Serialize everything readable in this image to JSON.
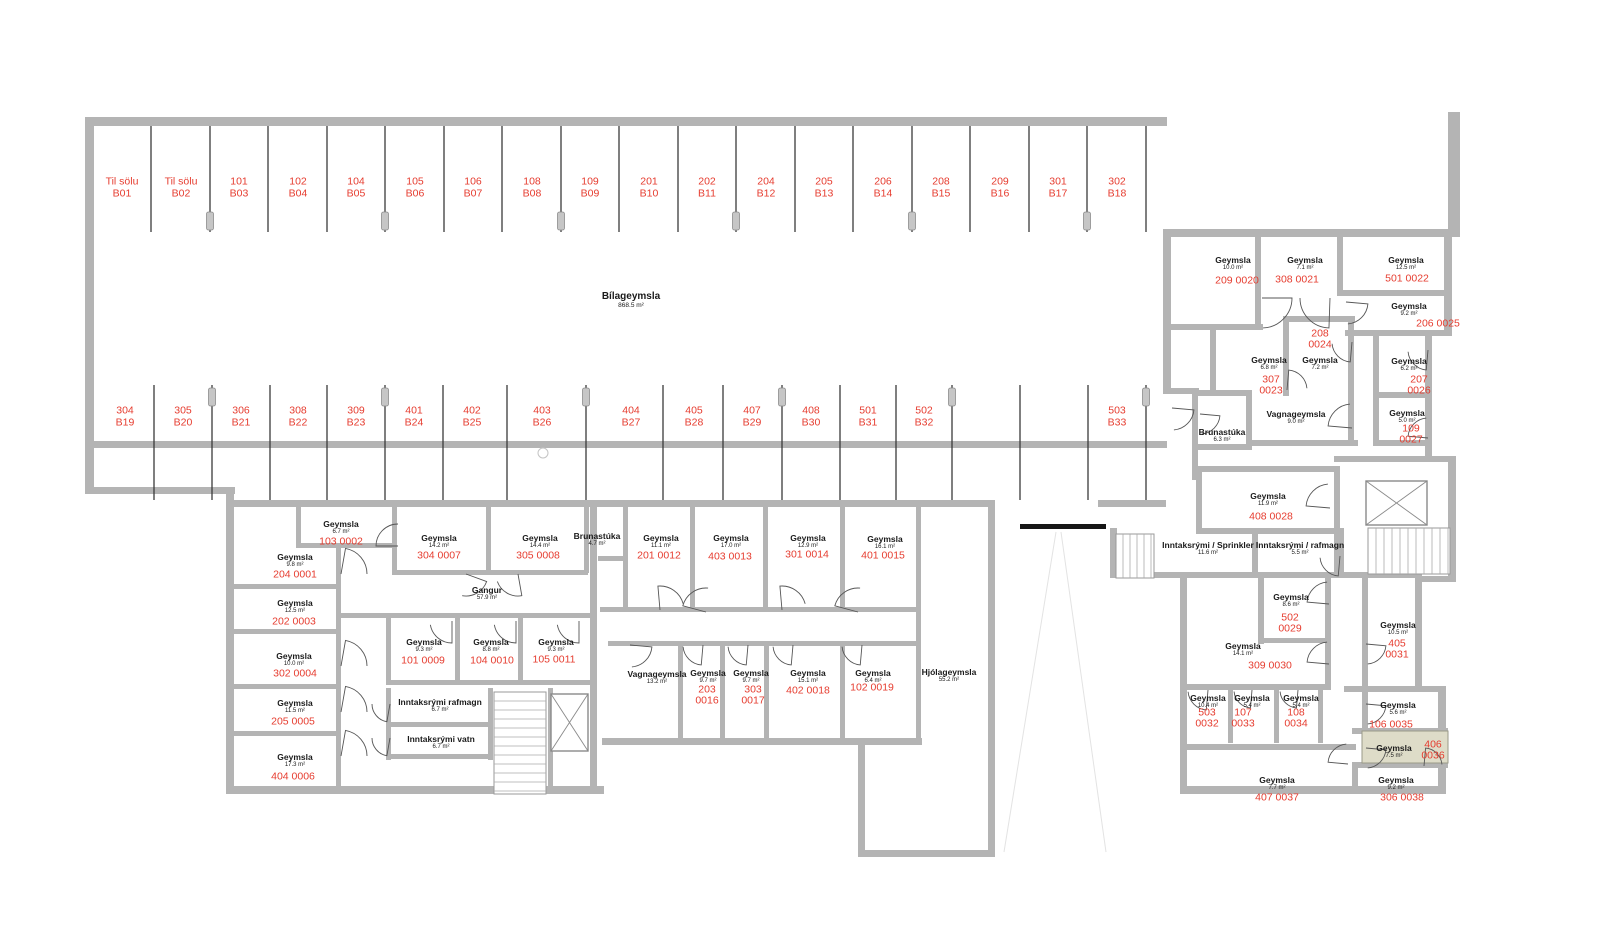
{
  "title": {
    "name": "Bílageymsla",
    "area": "868.5 m²",
    "x": 631,
    "y": 300
  },
  "colors": {
    "unit_red": "#e63c2f",
    "text_black": "#1a1a1a",
    "wall_gray": "#b4b4b4",
    "highlight_fill": "#dedcc8",
    "stall_line": "#3a3a3a"
  },
  "highlighted_unit": "406 0036",
  "parking_stalls": [
    {
      "unit": "Til sölu",
      "bay": "B01",
      "x": 122,
      "y": 188,
      "row": "top"
    },
    {
      "unit": "Til sölu",
      "bay": "B02",
      "x": 181,
      "y": 188,
      "row": "top"
    },
    {
      "unit": "101",
      "bay": "B03",
      "x": 239,
      "y": 188,
      "row": "top"
    },
    {
      "unit": "102",
      "bay": "B04",
      "x": 298,
      "y": 188,
      "row": "top"
    },
    {
      "unit": "104",
      "bay": "B05",
      "x": 356,
      "y": 188,
      "row": "top"
    },
    {
      "unit": "105",
      "bay": "B06",
      "x": 415,
      "y": 188,
      "row": "top"
    },
    {
      "unit": "106",
      "bay": "B07",
      "x": 473,
      "y": 188,
      "row": "top"
    },
    {
      "unit": "108",
      "bay": "B08",
      "x": 532,
      "y": 188,
      "row": "top"
    },
    {
      "unit": "109",
      "bay": "B09",
      "x": 590,
      "y": 188,
      "row": "top"
    },
    {
      "unit": "201",
      "bay": "B10",
      "x": 649,
      "y": 188,
      "row": "top"
    },
    {
      "unit": "202",
      "bay": "B11",
      "x": 707,
      "y": 188,
      "row": "top"
    },
    {
      "unit": "204",
      "bay": "B12",
      "x": 766,
      "y": 188,
      "row": "top"
    },
    {
      "unit": "205",
      "bay": "B13",
      "x": 824,
      "y": 188,
      "row": "top"
    },
    {
      "unit": "206",
      "bay": "B14",
      "x": 883,
      "y": 188,
      "row": "top"
    },
    {
      "unit": "208",
      "bay": "B15",
      "x": 941,
      "y": 188,
      "row": "top"
    },
    {
      "unit": "209",
      "bay": "B16",
      "x": 1000,
      "y": 188,
      "row": "top"
    },
    {
      "unit": "301",
      "bay": "B17",
      "x": 1058,
      "y": 188,
      "row": "top"
    },
    {
      "unit": "302",
      "bay": "B18",
      "x": 1117,
      "y": 188,
      "row": "top"
    },
    {
      "unit": "304",
      "bay": "B19",
      "x": 125,
      "y": 417,
      "row": "mid"
    },
    {
      "unit": "305",
      "bay": "B20",
      "x": 183,
      "y": 417,
      "row": "mid"
    },
    {
      "unit": "306",
      "bay": "B21",
      "x": 241,
      "y": 417,
      "row": "mid"
    },
    {
      "unit": "308",
      "bay": "B22",
      "x": 298,
      "y": 417,
      "row": "mid"
    },
    {
      "unit": "309",
      "bay": "B23",
      "x": 356,
      "y": 417,
      "row": "mid"
    },
    {
      "unit": "401",
      "bay": "B24",
      "x": 414,
      "y": 417,
      "row": "mid"
    },
    {
      "unit": "402",
      "bay": "B25",
      "x": 472,
      "y": 417,
      "row": "mid"
    },
    {
      "unit": "403",
      "bay": "B26",
      "x": 542,
      "y": 417,
      "row": "mid"
    },
    {
      "unit": "404",
      "bay": "B27",
      "x": 631,
      "y": 417,
      "row": "mid"
    },
    {
      "unit": "405",
      "bay": "B28",
      "x": 694,
      "y": 417,
      "row": "mid"
    },
    {
      "unit": "407",
      "bay": "B29",
      "x": 752,
      "y": 417,
      "row": "mid"
    },
    {
      "unit": "408",
      "bay": "B30",
      "x": 811,
      "y": 417,
      "row": "mid"
    },
    {
      "unit": "501",
      "bay": "B31",
      "x": 868,
      "y": 417,
      "row": "mid"
    },
    {
      "unit": "502",
      "bay": "B32",
      "x": 924,
      "y": 417,
      "row": "mid"
    },
    {
      "unit": "503",
      "bay": "B33",
      "x": 1117,
      "y": 417,
      "row": "mid"
    }
  ],
  "rooms": [
    {
      "name": "Geymsla",
      "area": "6.7 m²",
      "x": 341,
      "y": 528
    },
    {
      "name": "Geymsla",
      "area": "9.8 m²",
      "x": 295,
      "y": 561
    },
    {
      "name": "Geymsla",
      "area": "12.5 m²",
      "x": 295,
      "y": 607
    },
    {
      "name": "Geymsla",
      "area": "10.0 m²",
      "x": 294,
      "y": 660
    },
    {
      "name": "Geymsla",
      "area": "11.5 m²",
      "x": 295,
      "y": 707
    },
    {
      "name": "Geymsla",
      "area": "17.3 m²",
      "x": 295,
      "y": 761
    },
    {
      "name": "Geymsla",
      "area": "14.2 m²",
      "x": 439,
      "y": 542
    },
    {
      "name": "Geymsla",
      "area": "14.4 m²",
      "x": 540,
      "y": 542
    },
    {
      "name": "Brunastúka",
      "area": "4.7 m²",
      "x": 597,
      "y": 540
    },
    {
      "name": "Gangur",
      "area": "57.9 m²",
      "x": 487,
      "y": 594
    },
    {
      "name": "Geymsla",
      "area": "9.3 m²",
      "x": 424,
      "y": 646
    },
    {
      "name": "Geymsla",
      "area": "8.8 m²",
      "x": 491,
      "y": 646
    },
    {
      "name": "Geymsla",
      "area": "9.3 m²",
      "x": 556,
      "y": 646
    },
    {
      "name": "Inntaksrými rafmagn",
      "area": "6.7 m²",
      "x": 440,
      "y": 706
    },
    {
      "name": "Inntaksrými vatn",
      "area": "6.7 m²",
      "x": 441,
      "y": 743
    },
    {
      "name": "Geymsla",
      "area": "11.1 m²",
      "x": 661,
      "y": 542
    },
    {
      "name": "Geymsla",
      "area": "17.0 m²",
      "x": 731,
      "y": 542
    },
    {
      "name": "Geymsla",
      "area": "12.9 m²",
      "x": 808,
      "y": 542
    },
    {
      "name": "Geymsla",
      "area": "16.1 m²",
      "x": 885,
      "y": 543
    },
    {
      "name": "Vagnageymsla",
      "area": "13.2 m²",
      "x": 657,
      "y": 678
    },
    {
      "name": "Geymsla",
      "area": "9.7 m²",
      "x": 708,
      "y": 677
    },
    {
      "name": "Geymsla",
      "area": "9.7 m²",
      "x": 751,
      "y": 677
    },
    {
      "name": "Geymsla",
      "area": "15.1 m²",
      "x": 808,
      "y": 677
    },
    {
      "name": "Geymsla",
      "area": "6.4 m²",
      "x": 873,
      "y": 677
    },
    {
      "name": "Hjólageymsla",
      "area": "55.2 m²",
      "x": 949,
      "y": 676
    },
    {
      "name": "Geymsla",
      "area": "10.0 m²",
      "x": 1233,
      "y": 264
    },
    {
      "name": "Geymsla",
      "area": "7.1 m²",
      "x": 1305,
      "y": 264
    },
    {
      "name": "Geymsla",
      "area": "12.5 m²",
      "x": 1406,
      "y": 264
    },
    {
      "name": "Geymsla",
      "area": "9.2 m²",
      "x": 1409,
      "y": 310
    },
    {
      "name": "Geymsla",
      "area": "7.2 m²",
      "x": 1320,
      "y": 364
    },
    {
      "name": "Geymsla",
      "area": "6.8 m²",
      "x": 1269,
      "y": 364
    },
    {
      "name": "Geymsla",
      "area": "6.2 m²",
      "x": 1409,
      "y": 365
    },
    {
      "name": "Vagnageymsla",
      "area": "9.0 m²",
      "x": 1296,
      "y": 418
    },
    {
      "name": "Brunastúka",
      "area": "6.3 m²",
      "x": 1222,
      "y": 436
    },
    {
      "name": "Geymsla",
      "area": "5.0 m²",
      "x": 1407,
      "y": 417
    },
    {
      "name": "Geymsla",
      "area": "11.9 m²",
      "x": 1268,
      "y": 500
    },
    {
      "name": "Inntaksrými / Sprinkler",
      "area": "11.6 m²",
      "x": 1208,
      "y": 549
    },
    {
      "name": "Inntaksrými / rafmagn",
      "area": "5.5 m²",
      "x": 1300,
      "y": 549
    },
    {
      "name": "Geymsla",
      "area": "8.6 m²",
      "x": 1291,
      "y": 601
    },
    {
      "name": "Geymsla",
      "area": "14.1 m²",
      "x": 1243,
      "y": 650
    },
    {
      "name": "Geymsla",
      "area": "10.5 m²",
      "x": 1398,
      "y": 629
    },
    {
      "name": "Geymsla",
      "area": "10.4 m²",
      "x": 1208,
      "y": 702
    },
    {
      "name": "Geymsla",
      "area": "5.4 m²",
      "x": 1252,
      "y": 702
    },
    {
      "name": "Geymsla",
      "area": "5.4 m²",
      "x": 1301,
      "y": 702
    },
    {
      "name": "Geymsla",
      "area": "5.6 m²",
      "x": 1398,
      "y": 709
    },
    {
      "name": "Geymsla",
      "area": "7.5 m²",
      "x": 1394,
      "y": 752
    },
    {
      "name": "Geymsla",
      "area": "7.7 m²",
      "x": 1277,
      "y": 784
    },
    {
      "name": "Geymsla",
      "area": "9.2 m²",
      "x": 1396,
      "y": 784
    }
  ],
  "unit_ids": [
    {
      "id": "103 0002",
      "x": 341,
      "y": 542,
      "lines": 1
    },
    {
      "id": "204 0001",
      "x": 295,
      "y": 575,
      "lines": 1
    },
    {
      "id": "202 0003",
      "x": 294,
      "y": 622,
      "lines": 1
    },
    {
      "id": "302 0004",
      "x": 295,
      "y": 674,
      "lines": 1
    },
    {
      "id": "205 0005",
      "x": 293,
      "y": 722,
      "lines": 1
    },
    {
      "id": "404 0006",
      "x": 293,
      "y": 777,
      "lines": 1
    },
    {
      "id": "304 0007",
      "x": 439,
      "y": 556,
      "lines": 1
    },
    {
      "id": "305 0008",
      "x": 538,
      "y": 556,
      "lines": 1
    },
    {
      "id": "101 0009",
      "x": 423,
      "y": 661,
      "lines": 1
    },
    {
      "id": "104 0010",
      "x": 492,
      "y": 661,
      "lines": 1
    },
    {
      "id": "105 0011",
      "x": 554,
      "y": 660,
      "lines": 1
    },
    {
      "id": "201 0012",
      "x": 659,
      "y": 556,
      "lines": 1
    },
    {
      "id": "403 0013",
      "x": 730,
      "y": 557,
      "lines": 1
    },
    {
      "id": "301 0014",
      "x": 807,
      "y": 555,
      "lines": 1
    },
    {
      "id": "401 0015",
      "x": 883,
      "y": 556,
      "lines": 1
    },
    {
      "id": "203 0016",
      "x": 707,
      "y": 696,
      "lines": 2
    },
    {
      "id": "303 0017",
      "x": 753,
      "y": 696,
      "lines": 2
    },
    {
      "id": "402 0018",
      "x": 808,
      "y": 691,
      "lines": 1
    },
    {
      "id": "102 0019",
      "x": 872,
      "y": 688,
      "lines": 1
    },
    {
      "id": "209 0020",
      "x": 1237,
      "y": 281,
      "lines": 1
    },
    {
      "id": "308 0021",
      "x": 1297,
      "y": 280,
      "lines": 1
    },
    {
      "id": "501 0022",
      "x": 1407,
      "y": 279,
      "lines": 1
    },
    {
      "id": "206 0025",
      "x": 1438,
      "y": 324,
      "lines": 1
    },
    {
      "id": "208 0024",
      "x": 1320,
      "y": 340,
      "lines": 2
    },
    {
      "id": "307 0023",
      "x": 1271,
      "y": 386,
      "lines": 2
    },
    {
      "id": "207 0026",
      "x": 1419,
      "y": 386,
      "lines": 2
    },
    {
      "id": "109 0027",
      "x": 1411,
      "y": 435,
      "lines": 2
    },
    {
      "id": "408 0028",
      "x": 1271,
      "y": 517,
      "lines": 1
    },
    {
      "id": "502 0029",
      "x": 1290,
      "y": 624,
      "lines": 2
    },
    {
      "id": "309 0030",
      "x": 1270,
      "y": 666,
      "lines": 1
    },
    {
      "id": "405 0031",
      "x": 1397,
      "y": 650,
      "lines": 2
    },
    {
      "id": "503 0032",
      "x": 1207,
      "y": 719,
      "lines": 2
    },
    {
      "id": "107 0033",
      "x": 1243,
      "y": 719,
      "lines": 2
    },
    {
      "id": "108 0034",
      "x": 1296,
      "y": 719,
      "lines": 2
    },
    {
      "id": "106 0035",
      "x": 1391,
      "y": 725,
      "lines": 1
    },
    {
      "id": "406 0036",
      "x": 1433,
      "y": 751,
      "lines": 2
    },
    {
      "id": "407 0037",
      "x": 1277,
      "y": 798,
      "lines": 1
    },
    {
      "id": "306 0038",
      "x": 1402,
      "y": 798,
      "lines": 1
    }
  ]
}
